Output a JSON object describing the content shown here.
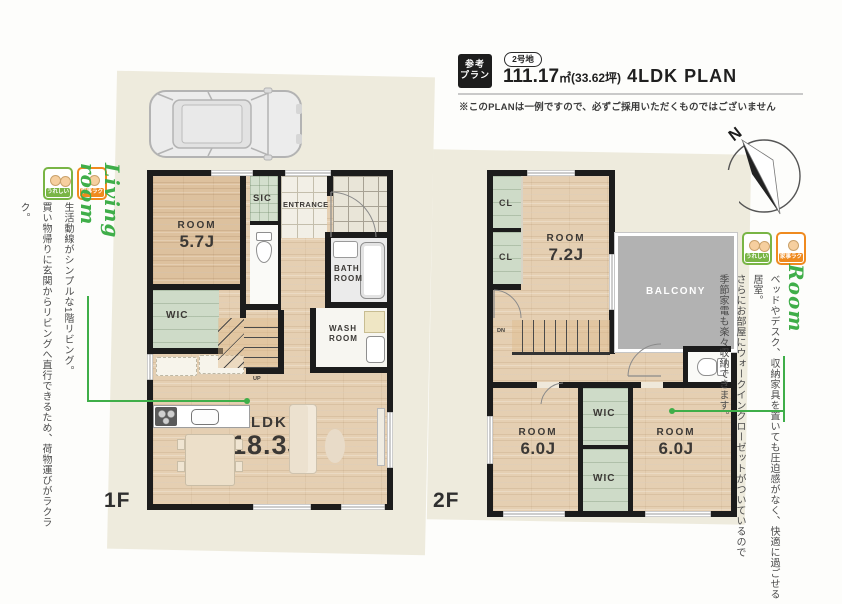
{
  "header": {
    "ref_badge_line1": "参考",
    "ref_badge_line2": "プラン",
    "lot_badge": "2号地",
    "area_value": "111.17",
    "area_unit": "㎡(33.62坪)",
    "plan_type": "4LDK PLAN",
    "disclaimer": "※このPLANは一例ですので、必ずご採用いただくものではございません"
  },
  "compass": {
    "north_label": "N"
  },
  "notes": {
    "living": {
      "script_title": "Living room",
      "badges": [
        {
          "label": "うれしい"
        },
        {
          "label": "家事ラク"
        }
      ],
      "lines": [
        "生活動線がシンプルな1階リビング。",
        "買い物帰りに玄関からリビングへ直行できるため、荷物運びがラクラク。"
      ]
    },
    "room": {
      "script_title": "Room",
      "badges": [
        {
          "label": "うれしい"
        },
        {
          "label": "家事ラク"
        }
      ],
      "lines": [
        "ベッドやデスク、収納家具を置いても圧迫感がなく、快適に過ごせる居室。",
        "さらにお部屋にウォークインクローゼットがついているので",
        "季節家電も楽々収納できます。"
      ]
    }
  },
  "floor1": {
    "label": "1F",
    "room_57": {
      "name": "ROOM",
      "size": "5.7J"
    },
    "sic": "SIC",
    "entrance": "ENTRANCE",
    "bathroom_line1": "BATH",
    "bathroom_line2": "ROOM",
    "wic": "WIC",
    "washroom_line1": "WASH",
    "washroom_line2": "ROOM",
    "ldk": {
      "name": "LDK",
      "size": "18.3J"
    },
    "stairs_label": "UP"
  },
  "floor2": {
    "label": "2F",
    "cl1": "CL",
    "cl2": "CL",
    "room_72": {
      "name": "ROOM",
      "size": "7.2J"
    },
    "balcony": "BALCONY",
    "stairs_label": "DN",
    "wic1": "WIC",
    "wic2": "WIC",
    "room_60a": {
      "name": "ROOM",
      "size": "6.0J"
    },
    "room_60b": {
      "name": "ROOM",
      "size": "6.0J"
    }
  },
  "colors": {
    "accent_green": "#3fae49",
    "panel_cream": "#eeebdd",
    "balcony_gray": "#b2b2b2",
    "badge_green": "#79b545",
    "badge_orange": "#ef8a1f"
  }
}
